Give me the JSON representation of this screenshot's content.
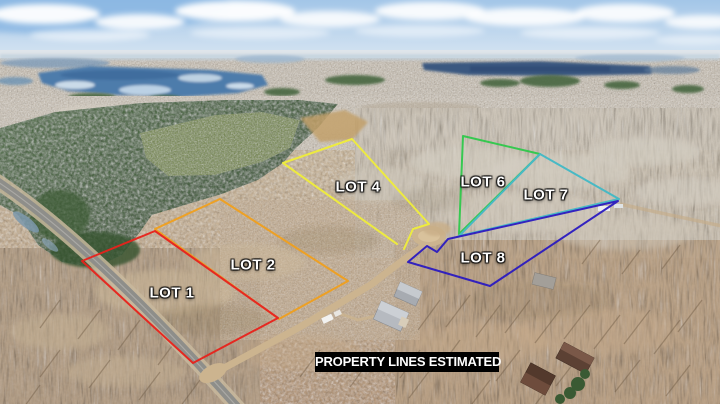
{
  "banner": {
    "text": "PROPERTY LINES ESTIMATED",
    "background": "#000000",
    "text_color": "#ffffff"
  },
  "lots": [
    {
      "label": "LOT 1",
      "color": "#e8221b"
    },
    {
      "label": "LOT 2",
      "color": "#f0a01e"
    },
    {
      "label": "LOT 4",
      "color": "#f0ee3a"
    },
    {
      "label": "LOT 6",
      "color": "#2fc94b"
    },
    {
      "label": "LOT 7",
      "color": "#41b9c6"
    },
    {
      "label": "LOT 8",
      "color": "#2b1bc0"
    }
  ],
  "label_text_color": "#ffffff"
}
